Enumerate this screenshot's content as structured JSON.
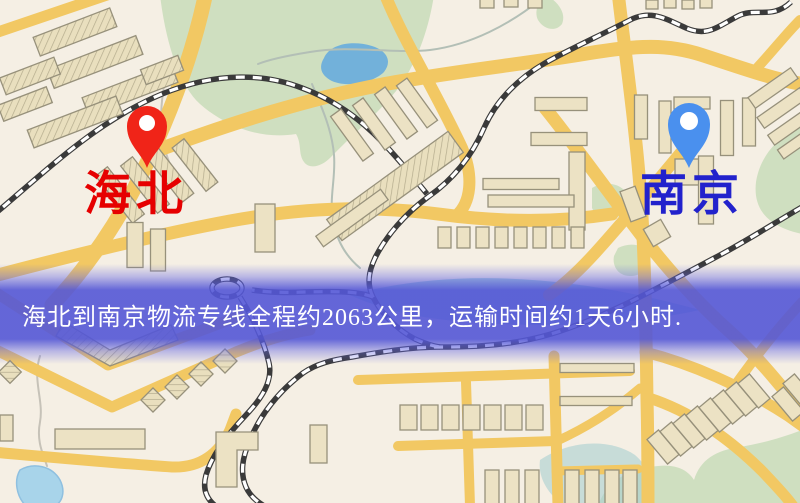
{
  "banner": {
    "text": "海北到南京物流专线全程约2063公里，运输时间约1天6小时."
  },
  "markers": {
    "origin": {
      "label": "海北",
      "icon": "red-location-pin-icon"
    },
    "destination": {
      "label": "南京",
      "icon": "blue-location-pin-icon"
    }
  },
  "colors": {
    "map-bg": "#f5efe4",
    "road": "#f2c863",
    "park": "#cfdfc0",
    "water-lake": "#72b1da",
    "water-pond": "#a8d4ea",
    "river": "#8fc3cf",
    "building": "#ece2c4",
    "building-outline": "#97917b",
    "railway-dark": "#3a3a3a",
    "origin-pin": "#f02418",
    "origin-label": "#e60000",
    "destination-pin": "#4a90ee",
    "destination-label": "#2222cc",
    "banner-bg": "#5457d6",
    "banner-text": "#ffffff"
  }
}
